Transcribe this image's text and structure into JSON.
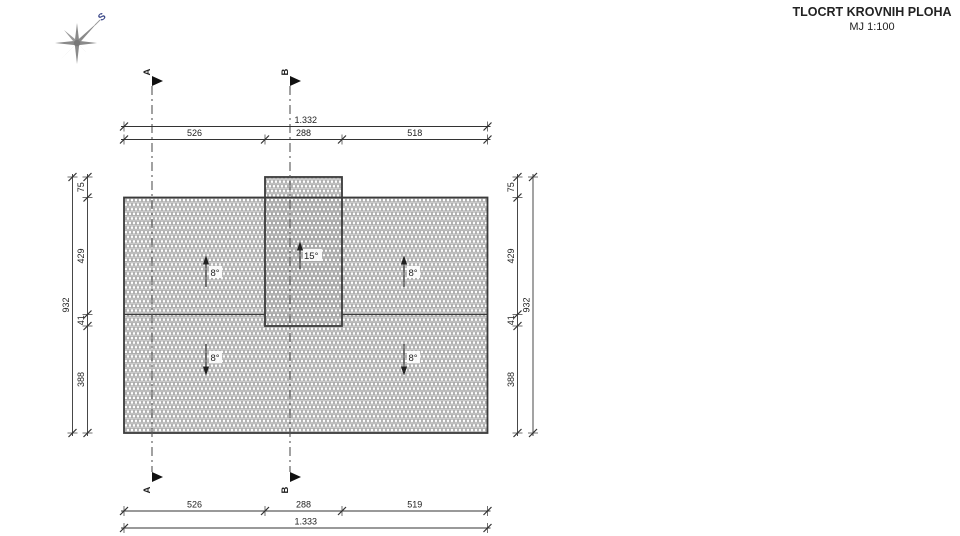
{
  "title": {
    "main": "TLOCRT KROVNIH PLOHA",
    "scale": "MJ 1:100"
  },
  "compass": {
    "north_label": "S"
  },
  "section_markers": {
    "a": "A",
    "b": "B"
  },
  "dimensions": {
    "top": {
      "total": "1.332",
      "segments": [
        "526",
        "288",
        "518"
      ]
    },
    "bottom": {
      "total": "1.333",
      "segments": [
        "526",
        "288",
        "519"
      ]
    },
    "left": {
      "total": "932",
      "segments": [
        "75",
        "429",
        "41",
        "388"
      ]
    },
    "right": {
      "total": "932",
      "segments": [
        "75",
        "429",
        "41",
        "388"
      ]
    }
  },
  "slope_labels": {
    "upper_left": "8°",
    "upper_right": "8°",
    "lower_left": "8°",
    "lower_right": "8°",
    "tower": "15°"
  },
  "colors": {
    "hatch": "#a8a8a8",
    "outline": "#3a3a3a",
    "dimension_line": "#333333",
    "text": "#222222",
    "section_line": "#555555",
    "compass_star": "#8a8a8a",
    "compass_label": "#3e4a8a"
  }
}
